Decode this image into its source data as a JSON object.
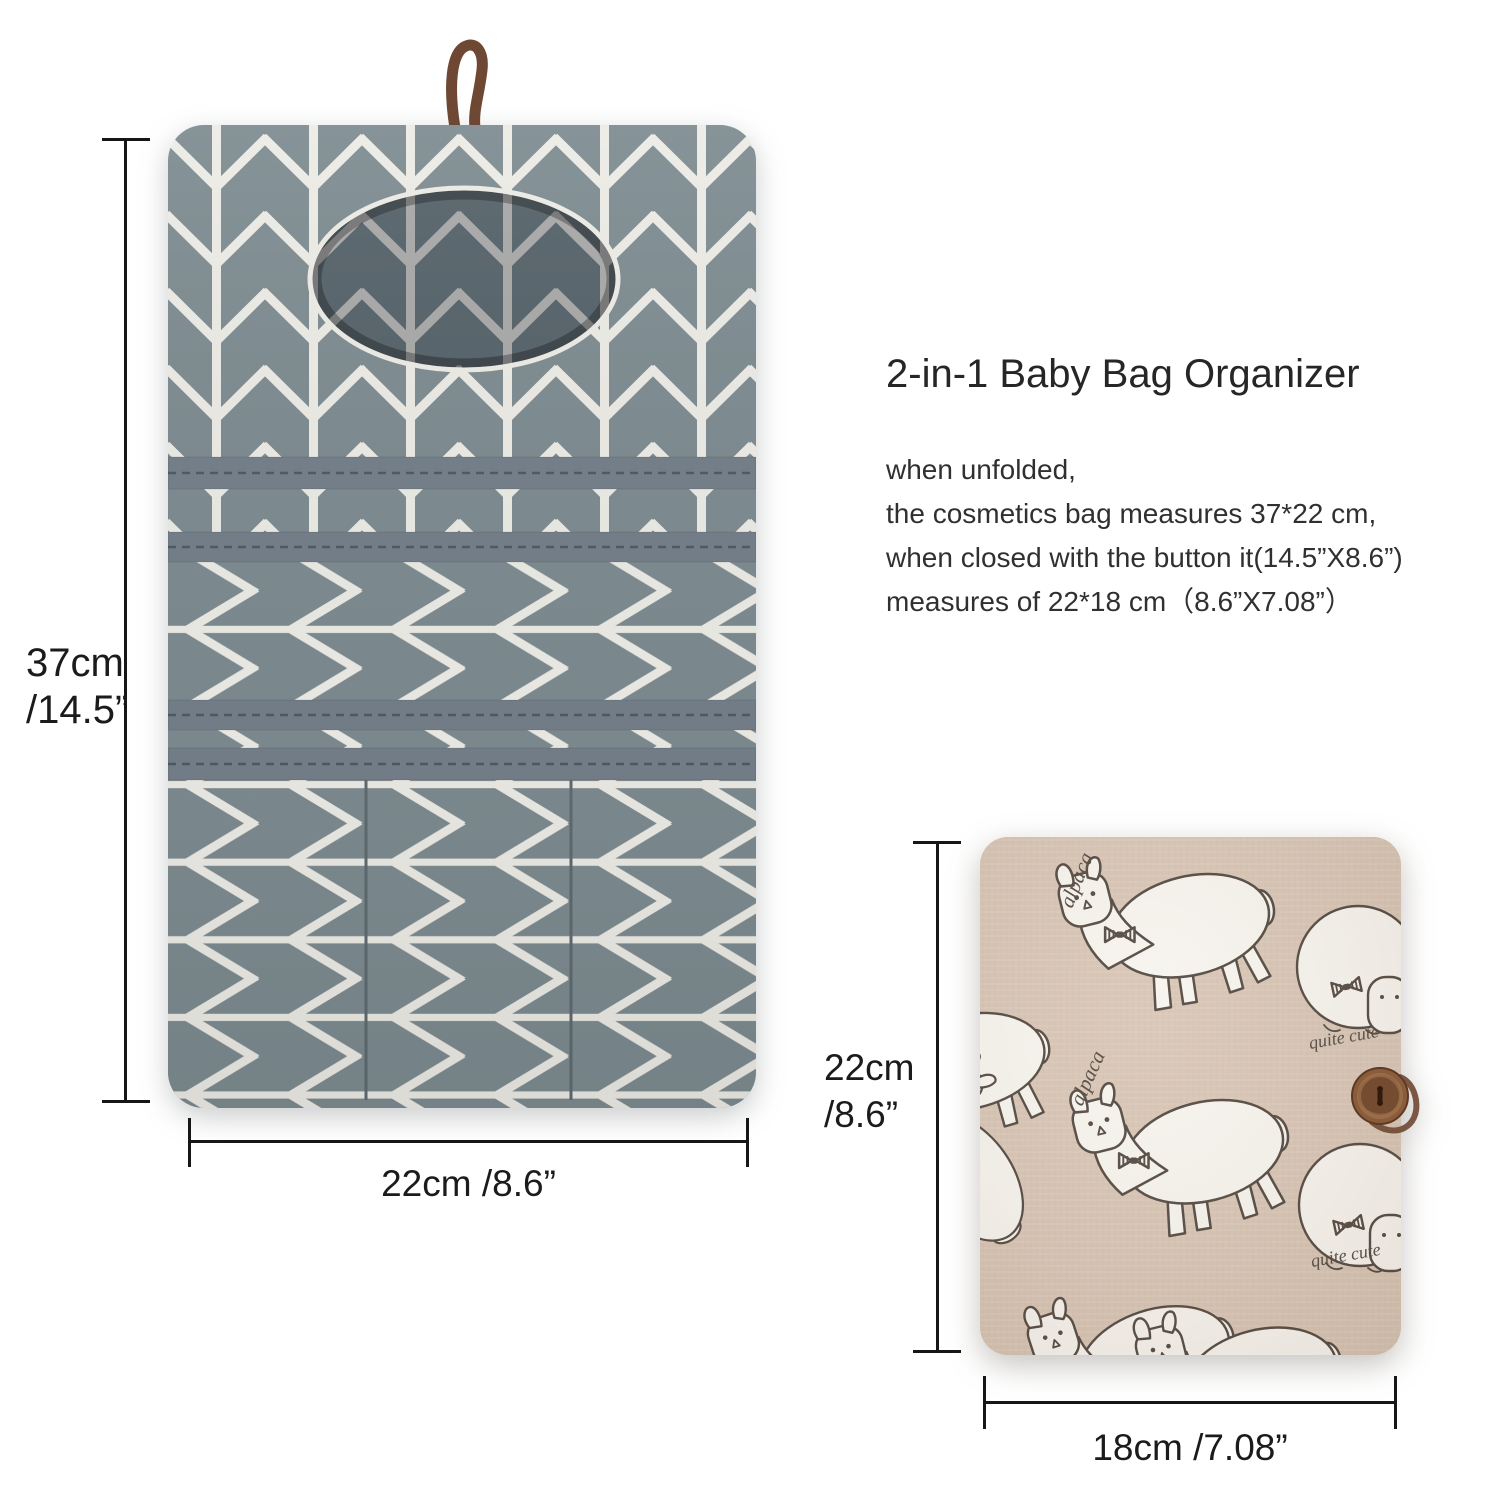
{
  "colors": {
    "page_bg": "#ffffff",
    "fabric_gray": "#7d8b90",
    "fabric_stripe": "#ecebe5",
    "fabric_gray_dark": "#66747a",
    "fabric_stripe_dark": "#cfcec9",
    "band_gray": "#747f8a",
    "band_stitch": "#4e5a64",
    "pocket_stitch": "#5f6b70",
    "loop_brown": "#6f4833",
    "beige": "#d6c2b1",
    "motif_white": "#f7f4ee",
    "motif_outline": "#4b4138",
    "button_brown": "#8a5c3c",
    "button_dark": "#5e3a24",
    "dim_line": "#161616",
    "text_dark": "#262626",
    "text_body": "#303030"
  },
  "info_panel": {
    "title": "2-in-1 Baby Bag Organizer",
    "lines": [
      "when unfolded,",
      "the cosmetics bag measures 37*22 cm,",
      "when closed with the button it(14.5”X8.6”)",
      "measures of 22*18 cm（8.6”X7.08”）"
    ]
  },
  "unfolded": {
    "height_cm": "37cm",
    "height_in": "/14.5”",
    "width_label": "22cm /8.6”"
  },
  "folded": {
    "height_cm": "22cm",
    "height_in": "/8.6”",
    "width_label": "18cm /7.08”"
  },
  "fabric_words": {
    "alpaca": "alpaca",
    "cute": "quite cute"
  }
}
